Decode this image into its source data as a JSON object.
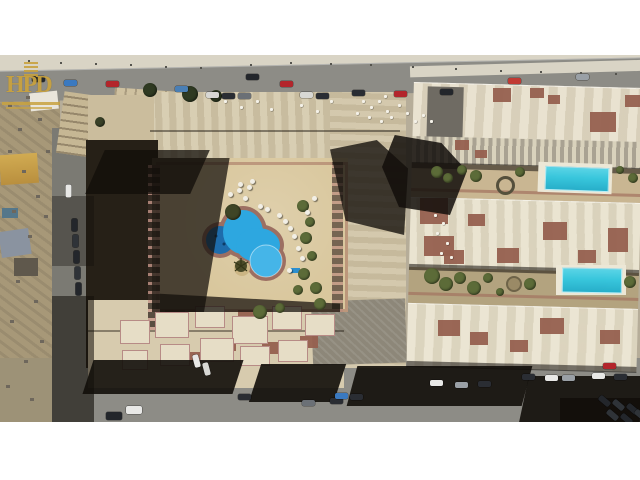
{
  "meta": {
    "description": "Aerial drone photograph of a beige residential compound with a freeform courtyard swimming pool, neighbouring rooftop rows with two turquoise pools, roads with cars, letterboxed on white"
  },
  "watermark": {
    "monogram": "HPD"
  },
  "colors": {
    "band": "#ffffff",
    "road": "#8d8c86",
    "sidewalk": "#d9d4c5",
    "dirt": "#a79878",
    "roof": "#d4c8aa",
    "roofLight": "#e4dcc6",
    "brick": "#96604f",
    "deck": "#d9c79d",
    "poolMain": "#2da7e0",
    "poolDark": "#1e6cab",
    "poolT": "#38c6dc",
    "green": "#5c6b38",
    "gold": "#c8a23f"
  },
  "scene": {
    "top_road_cars": [
      {
        "x": 32,
        "y": 76,
        "c": "#23262b"
      },
      {
        "x": 64,
        "y": 80,
        "c": "#3a79c0"
      },
      {
        "x": 106,
        "y": 81,
        "c": "#b3252b"
      },
      {
        "x": 175,
        "y": 86,
        "c": "#4a7fb5"
      },
      {
        "x": 246,
        "y": 74,
        "c": "#23262b"
      },
      {
        "x": 280,
        "y": 81,
        "c": "#b3252b"
      },
      {
        "x": 352,
        "y": 90,
        "c": "#2a2d33"
      },
      {
        "x": 394,
        "y": 91,
        "c": "#b3252b"
      },
      {
        "x": 440,
        "y": 89,
        "c": "#23262b"
      },
      {
        "x": 508,
        "y": 78,
        "c": "#c13a33"
      },
      {
        "x": 576,
        "y": 74,
        "c": "#9aa0a6"
      },
      {
        "x": 206,
        "y": 92,
        "c": "#d8d8d4"
      },
      {
        "x": 222,
        "y": 93,
        "c": "#2a2d33"
      },
      {
        "x": 238,
        "y": 93,
        "c": "#6b7076"
      },
      {
        "x": 300,
        "y": 92,
        "c": "#d8d8d4"
      },
      {
        "x": 316,
        "y": 93,
        "c": "#2a2d33"
      }
    ],
    "bottom_road_cars": [
      {
        "x": 522,
        "y": 374,
        "c": "#2a2d33"
      },
      {
        "x": 545,
        "y": 375,
        "c": "#e8e8e6"
      },
      {
        "x": 562,
        "y": 375,
        "c": "#9aa0a6"
      },
      {
        "x": 592,
        "y": 373,
        "c": "#e8e8e6"
      },
      {
        "x": 614,
        "y": 374,
        "c": "#2a2d33"
      },
      {
        "x": 603,
        "y": 363,
        "c": "#b3252b"
      },
      {
        "x": 430,
        "y": 380,
        "c": "#e8e8e6"
      },
      {
        "x": 455,
        "y": 382,
        "c": "#9aa0a6"
      },
      {
        "x": 478,
        "y": 381,
        "c": "#2a2d33"
      },
      {
        "x": 330,
        "y": 398,
        "c": "#2a2d33"
      },
      {
        "x": 302,
        "y": 400,
        "c": "#6b7076"
      },
      {
        "x": 238,
        "y": 394,
        "c": "#2a2d33"
      },
      {
        "x": 126,
        "y": 406,
        "c": "#e8e8e6",
        "w": 16,
        "h": 8
      },
      {
        "x": 106,
        "y": 412,
        "c": "#23262b",
        "w": 16,
        "h": 8
      },
      {
        "x": 335,
        "y": 393,
        "c": "#3a79c0"
      },
      {
        "x": 350,
        "y": 394,
        "c": "#2a2d33"
      },
      {
        "x": 598,
        "y": 398,
        "c": "#23262b",
        "a": 40
      },
      {
        "x": 612,
        "y": 402,
        "c": "#2f3338",
        "a": 40
      },
      {
        "x": 626,
        "y": 406,
        "c": "#23262b",
        "a": 40
      },
      {
        "x": 606,
        "y": 412,
        "c": "#2f3338",
        "a": 40
      },
      {
        "x": 620,
        "y": 416,
        "c": "#23262b",
        "a": 40
      },
      {
        "x": 634,
        "y": 412,
        "c": "#2f3338",
        "a": 40
      }
    ],
    "street_cars": [
      {
        "x": 62,
        "y": 188,
        "c": "#e8e8e6",
        "a": 90
      },
      {
        "x": 68,
        "y": 222,
        "c": "#23262b",
        "a": 90
      },
      {
        "x": 69,
        "y": 238,
        "c": "#2f3338",
        "a": 90
      },
      {
        "x": 70,
        "y": 254,
        "c": "#23262b",
        "a": 90
      },
      {
        "x": 71,
        "y": 270,
        "c": "#2f3338",
        "a": 90
      },
      {
        "x": 72,
        "y": 286,
        "c": "#23262b",
        "a": 90
      },
      {
        "x": 190,
        "y": 358,
        "c": "#e8e8e6",
        "a": 75
      },
      {
        "x": 200,
        "y": 366,
        "c": "#d8d8d4",
        "a": 75
      }
    ],
    "umbrellas": [
      [
        237,
        188
      ],
      [
        247,
        185
      ],
      [
        258,
        204
      ],
      [
        265,
        207
      ],
      [
        277,
        213
      ],
      [
        283,
        219
      ],
      [
        288,
        226
      ],
      [
        292,
        234
      ],
      [
        296,
        246
      ],
      [
        300,
        256
      ],
      [
        287,
        268
      ],
      [
        243,
        196
      ],
      [
        228,
        192
      ],
      [
        305,
        210
      ],
      [
        312,
        196
      ],
      [
        238,
        182
      ],
      [
        250,
        179
      ]
    ],
    "roof_dots": [
      [
        362,
        100
      ],
      [
        370,
        106
      ],
      [
        378,
        100
      ],
      [
        386,
        110
      ],
      [
        368,
        116
      ],
      [
        380,
        120
      ],
      [
        390,
        116
      ],
      [
        398,
        104
      ],
      [
        406,
        112
      ],
      [
        356,
        112
      ],
      [
        384,
        95
      ],
      [
        414,
        120
      ],
      [
        422,
        114
      ],
      [
        430,
        120
      ],
      [
        224,
        100
      ],
      [
        240,
        106
      ],
      [
        256,
        100
      ],
      [
        270,
        108
      ],
      [
        300,
        104
      ],
      [
        316,
        110
      ],
      [
        330,
        100
      ],
      [
        434,
        214
      ],
      [
        442,
        222
      ],
      [
        436,
        232
      ],
      [
        446,
        242
      ],
      [
        440,
        252
      ],
      [
        450,
        256
      ]
    ],
    "red_patches": [
      [
        493,
        88,
        18,
        14
      ],
      [
        530,
        88,
        14,
        10
      ],
      [
        590,
        112,
        26,
        20
      ],
      [
        548,
        95,
        12,
        9
      ],
      [
        625,
        95,
        15,
        12
      ],
      [
        455,
        140,
        14,
        10
      ],
      [
        475,
        150,
        12,
        8
      ],
      [
        420,
        198,
        28,
        26
      ],
      [
        424,
        236,
        30,
        20
      ],
      [
        543,
        222,
        24,
        18
      ],
      [
        497,
        248,
        22,
        15
      ],
      [
        608,
        228,
        20,
        24
      ],
      [
        468,
        214,
        17,
        12
      ],
      [
        444,
        250,
        20,
        14
      ],
      [
        578,
        250,
        18,
        13
      ],
      [
        438,
        320,
        22,
        16
      ],
      [
        470,
        332,
        18,
        13
      ],
      [
        540,
        318,
        24,
        16
      ],
      [
        600,
        330,
        20,
        14
      ],
      [
        510,
        340,
        18,
        12
      ],
      [
        165,
        310,
        20,
        12
      ],
      [
        212,
        338,
        24,
        13
      ],
      [
        262,
        342,
        26,
        12
      ],
      [
        300,
        336,
        18,
        12
      ],
      [
        190,
        352,
        22,
        10
      ],
      [
        238,
        310,
        18,
        10
      ]
    ],
    "units": [
      [
        155,
        312,
        34,
        26
      ],
      [
        195,
        306,
        30,
        22
      ],
      [
        232,
        316,
        36,
        28
      ],
      [
        272,
        306,
        30,
        24
      ],
      [
        305,
        314,
        30,
        22
      ],
      [
        160,
        344,
        30,
        22
      ],
      [
        200,
        338,
        34,
        24
      ],
      [
        240,
        346,
        30,
        20
      ],
      [
        278,
        340,
        30,
        22
      ],
      [
        120,
        320,
        30,
        24
      ],
      [
        122,
        350,
        26,
        20
      ]
    ],
    "green_blobs": [
      [
        303,
        206,
        6
      ],
      [
        310,
        222,
        5
      ],
      [
        306,
        238,
        6
      ],
      [
        312,
        256,
        5
      ],
      [
        304,
        274,
        6
      ],
      [
        298,
        290,
        5
      ],
      [
        316,
        288,
        6
      ],
      [
        320,
        304,
        6
      ],
      [
        260,
        312,
        7
      ],
      [
        280,
        308,
        5
      ],
      [
        437,
        172,
        6
      ],
      [
        448,
        178,
        5
      ],
      [
        462,
        170,
        5
      ],
      [
        476,
        176,
        6
      ],
      [
        520,
        172,
        5
      ],
      [
        620,
        170,
        4
      ],
      [
        633,
        178,
        5
      ],
      [
        432,
        276,
        8
      ],
      [
        446,
        284,
        7
      ],
      [
        460,
        278,
        6
      ],
      [
        474,
        288,
        7
      ],
      [
        488,
        278,
        5
      ],
      [
        530,
        284,
        6
      ],
      [
        630,
        282,
        6
      ],
      [
        500,
        292,
        4
      ],
      [
        150,
        90,
        7,
        "#2f3a22"
      ],
      [
        190,
        94,
        8,
        "#2f3a22"
      ],
      [
        216,
        96,
        6,
        "#2f3a22"
      ],
      [
        100,
        122,
        5,
        "#3a4228"
      ],
      [
        233,
        212,
        8,
        "#3f4526"
      ]
    ],
    "sidewalk_specks": [
      [
        28,
        60
      ],
      [
        60,
        62
      ],
      [
        95,
        63
      ],
      [
        130,
        64
      ],
      [
        165,
        66
      ],
      [
        200,
        67
      ],
      [
        250,
        64
      ],
      [
        290,
        62
      ],
      [
        330,
        63
      ],
      [
        370,
        64
      ],
      [
        412,
        66
      ],
      [
        455,
        68
      ],
      [
        500,
        70
      ],
      [
        540,
        71
      ],
      [
        580,
        72
      ],
      [
        615,
        73
      ]
    ],
    "debris": [
      [
        8,
        150
      ],
      [
        22,
        170
      ],
      [
        36,
        195
      ],
      [
        12,
        210
      ],
      [
        28,
        235
      ],
      [
        44,
        215
      ],
      [
        16,
        280
      ],
      [
        34,
        300
      ],
      [
        10,
        320
      ],
      [
        40,
        340
      ],
      [
        24,
        360
      ],
      [
        6,
        385
      ],
      [
        30,
        398
      ],
      [
        46,
        150
      ],
      [
        18,
        128
      ],
      [
        38,
        118
      ],
      [
        8,
        104
      ],
      [
        26,
        96
      ]
    ],
    "pools": {
      "courtyard_main": {
        "color_key": "poolMain"
      },
      "courtyard_round": {
        "color_key": "poolDark"
      },
      "garden1_rect": {
        "x": 545,
        "y": 167,
        "w": 62,
        "h": 22
      },
      "garden2_rect": {
        "x": 562,
        "y": 268,
        "w": 58,
        "h": 23
      }
    }
  }
}
